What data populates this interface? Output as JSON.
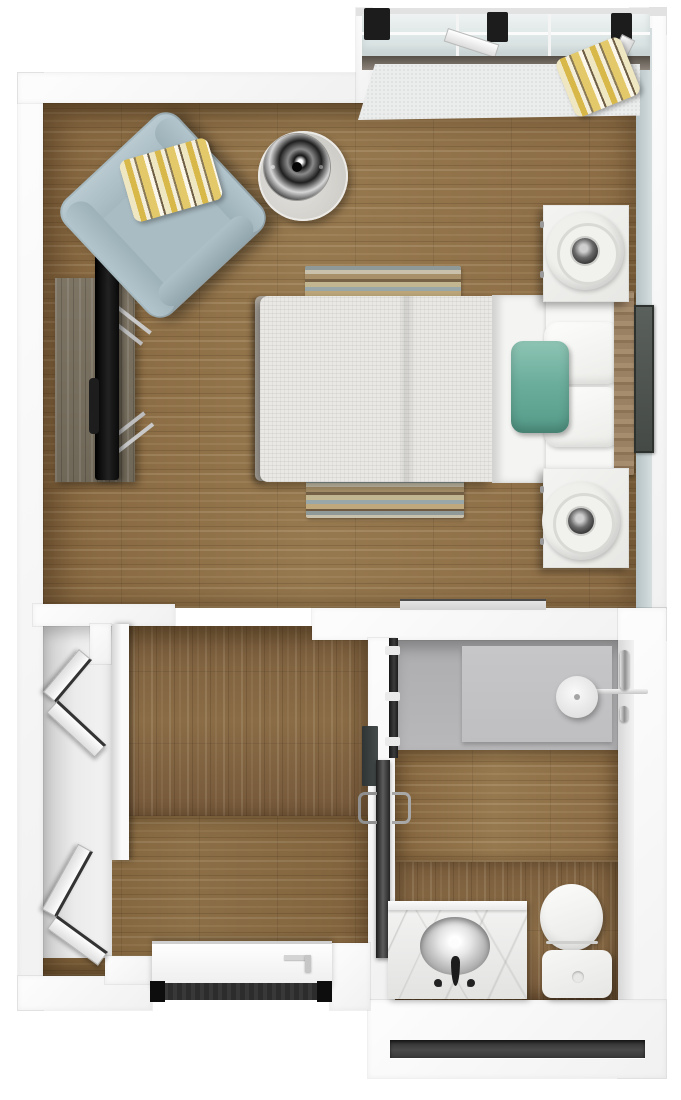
{
  "plan": {
    "title": "Studio apartment 3D top-down floor plan",
    "view": "top-down render",
    "canvas": {
      "width": 681,
      "height": 1100
    }
  },
  "colors": {
    "background": "#ffffff",
    "wall": "#f8f8f8",
    "wall_accent_blue": "#c6d2d4",
    "floor_wood": "#8d6e48",
    "floor_wood_dark": "#7f6140",
    "shower_floor": "#b9b9bb",
    "armchair_blue": "#a9bcc3",
    "accent_teal": "#6fae9d",
    "accent_yellow": "#d9b84a",
    "marble": "#ececeb",
    "tv_black": "#151515",
    "mat_dark": "#2c2c2c",
    "window_glass": "#e3eaea"
  },
  "rooms": {
    "bedroom": {
      "label": "Bedroom / Living Area",
      "items": {
        "window_bay": "Bay window with bench seat",
        "bench_pillow": "Yellow striped pillow on window bench",
        "armchair": "Light blue armchair",
        "armchair_pillow": "Yellow striped accent pillow",
        "floor_lamp": "Drum-shade floor lamp",
        "tv_console": "Rustic media console",
        "tv": "Flat-screen TV",
        "bed": "Bed with white duvet",
        "teal_pillow": "Teal accent pillow",
        "headboard": "Wood headboard",
        "artwork": "Wall artwork beside headboard",
        "nightstand_top": "Nightstand with round table lamp",
        "nightstand_bottom": "Nightstand with round table lamp",
        "rug_head": "Striped runner rug at head of bed",
        "rug_foot": "Striped runner rug at foot of bed"
      }
    },
    "hallway": {
      "label": "Entry hall with closet",
      "items": {
        "closet_door_upper": "Open bifold closet door",
        "closet_door_lower": "Open bifold closet door",
        "closet_partition": "Closet partition wall",
        "entry_door": "Open entry door",
        "entry_mat": "Dark threshold mat",
        "wall_panel": "Dark wall-mounted panel"
      }
    },
    "bathroom": {
      "label": "Bathroom",
      "items": {
        "sliding_door": "Dark sliding bathroom door",
        "door_handle": "Chrome door pull",
        "shower": "Roll-in shower with gray floor pan",
        "shower_head": "Overhead rain shower head on wall arm",
        "grab_bar": "Chrome grab bar",
        "vanity": "Marble vanity counter",
        "sink": "Oval sink basin with faucet",
        "toilet": "Toilet with round lid and tank",
        "vent": "Dark baseboard vent in south wall"
      }
    }
  }
}
